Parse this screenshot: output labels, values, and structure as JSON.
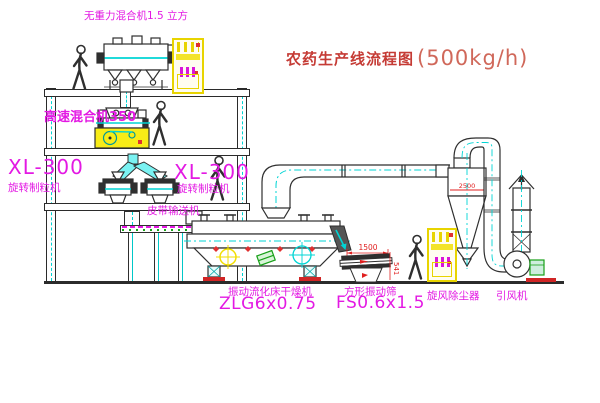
{
  "title": {
    "name_cn": "农药生产线流程图",
    "capacity": "(500kg/h)"
  },
  "labels": {
    "mixer_top": "无重力混合机1.5 立方",
    "high_speed_mixer": "高速混合机350",
    "xl300_left": "XL-300",
    "granulator_left": "旋转制粒机",
    "xl300_mid": "XL-300",
    "granulator_mid": "旋转制粒机",
    "belt_conveyor": "皮带输送机",
    "dryer": "振动流化床干燥机",
    "dryer_model": "ZLG6x0.75",
    "sieve": "方形振动筛",
    "sieve_model": "FS0.6x1.5",
    "cyclone": "旋风除尘器",
    "fan": "引风机"
  },
  "dimensions": {
    "sieve_length": "1500",
    "sieve_height": "541",
    "cyclone": "2500"
  },
  "colors": {
    "line": "#2f2f2f",
    "cyan": "#00d4d4",
    "magenta": "#e319e3",
    "title_red": "#c53b35",
    "dim_red": "#e02020",
    "cabinet_yellow": "#e8d400",
    "green": "#18a018"
  }
}
